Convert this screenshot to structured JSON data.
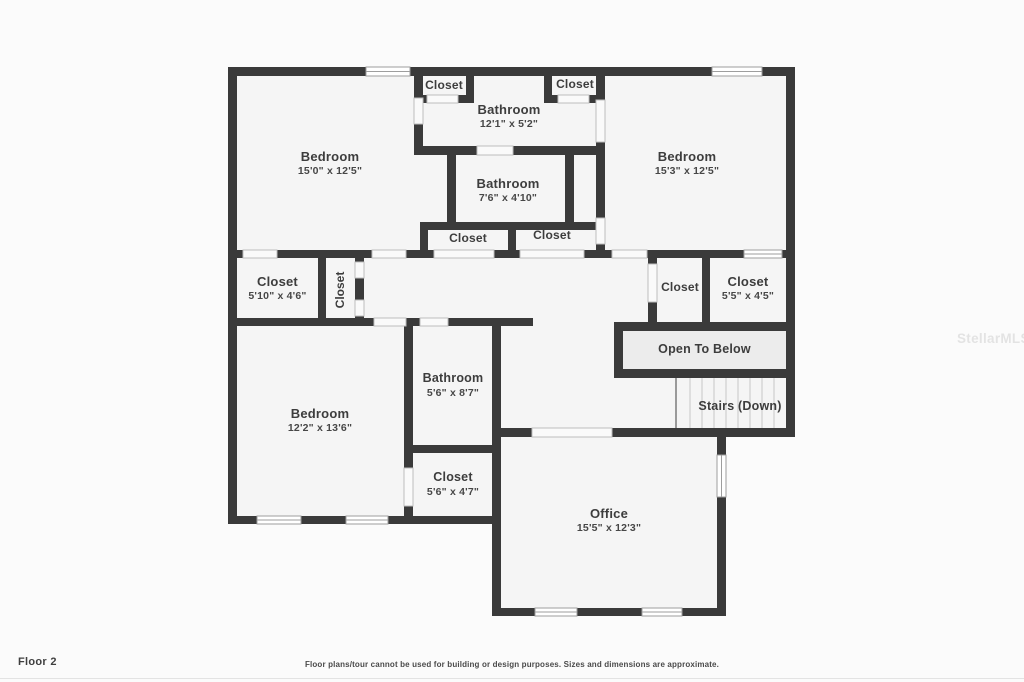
{
  "colors": {
    "wall": "#3a3a3a",
    "room_fill": "#f5f5f5",
    "open_to_below_fill": "#ececec",
    "label_text": "#3d3d3d"
  },
  "watermark": "StellarMLS",
  "footer": {
    "floor_label": "Floor 2",
    "disclaimer": "Floor plans/tour cannot be used for building or design purposes. Sizes and dimensions are approximate."
  },
  "rooms": [
    {
      "id": "bedroom-top-left",
      "name": "Bedroom",
      "dims": "15'0\" x 12'5\""
    },
    {
      "id": "closet-top-left",
      "name": "Closet",
      "dims": ""
    },
    {
      "id": "bathroom-top",
      "name": "Bathroom",
      "dims": "12'1\" x 5'2\""
    },
    {
      "id": "closet-top-right",
      "name": "Closet",
      "dims": ""
    },
    {
      "id": "bedroom-top-right",
      "name": "Bedroom",
      "dims": "15'3\" x 12'5\""
    },
    {
      "id": "bathroom-middle",
      "name": "Bathroom",
      "dims": "7'6\" x 4'10\""
    },
    {
      "id": "closet-mid-left",
      "name": "Closet",
      "dims": ""
    },
    {
      "id": "closet-mid-right",
      "name": "Closet",
      "dims": ""
    },
    {
      "id": "closet-hall-left",
      "name": "Closet",
      "dims": "5'10\" x 4'6\""
    },
    {
      "id": "closet-hall-vertical",
      "name": "Closet",
      "dims": ""
    },
    {
      "id": "closet-hall-right-1",
      "name": "Closet",
      "dims": ""
    },
    {
      "id": "closet-hall-right-2",
      "name": "Closet",
      "dims": "5'5\" x 4'5\""
    },
    {
      "id": "open-to-below",
      "name": "Open To Below",
      "dims": ""
    },
    {
      "id": "stairs-down",
      "name": "Stairs (Down)",
      "dims": ""
    },
    {
      "id": "bedroom-bottom-left",
      "name": "Bedroom",
      "dims": "12'2\" x 13'6\""
    },
    {
      "id": "bathroom-bottom",
      "name": "Bathroom",
      "dims": "5'6\" x 8'7\""
    },
    {
      "id": "closet-bottom",
      "name": "Closet",
      "dims": "5'6\" x 4'7\""
    },
    {
      "id": "office",
      "name": "Office",
      "dims": "15'5\" x 12'3\""
    }
  ]
}
